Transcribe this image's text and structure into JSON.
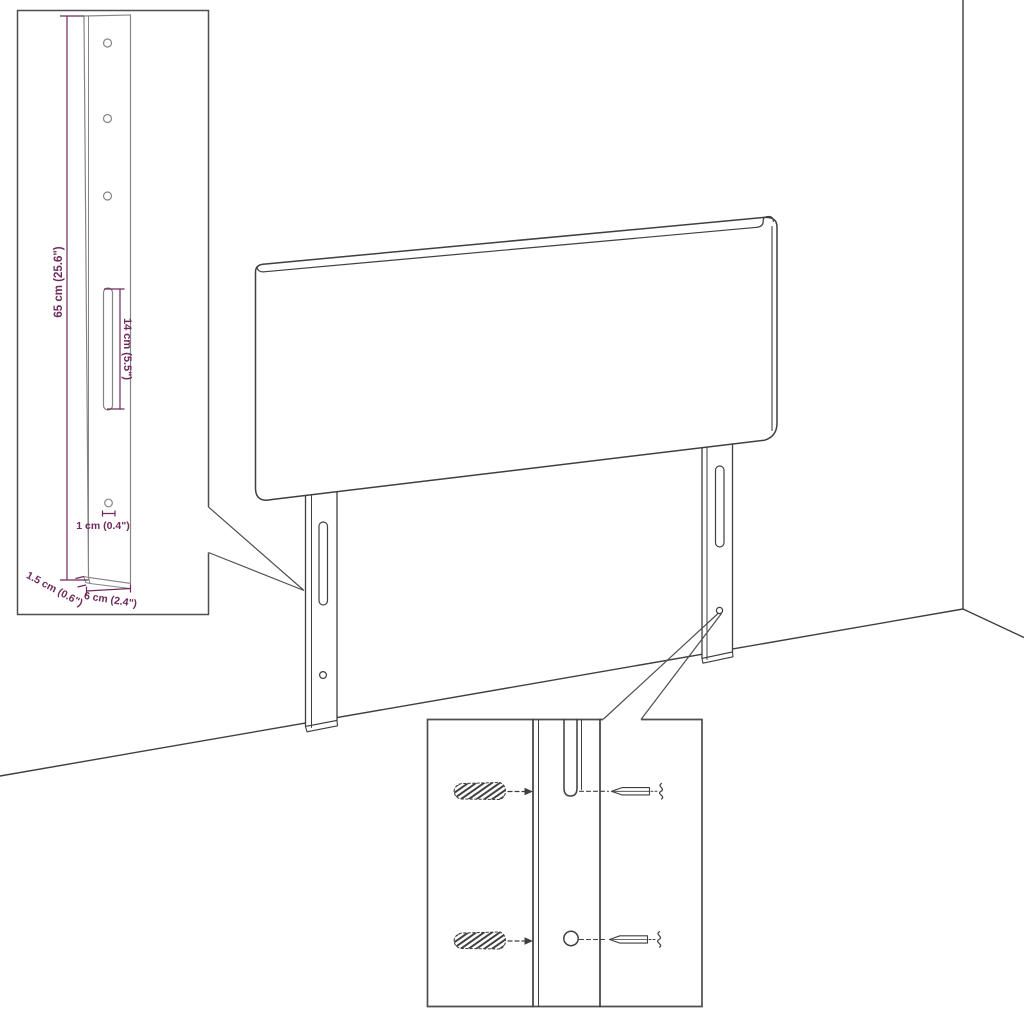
{
  "diagram": {
    "accent_color": "#6e2a5c",
    "line_color": "#3f3f3f",
    "bracket_inset": {
      "height_label": "65 cm (25.6\")",
      "slot_label": "14 cm (5.5\")",
      "hole_label": "1 cm (0.4\")",
      "thickness_label": "1.5 cm (0.6\")",
      "width_label": "6 cm (2.4\")"
    }
  }
}
